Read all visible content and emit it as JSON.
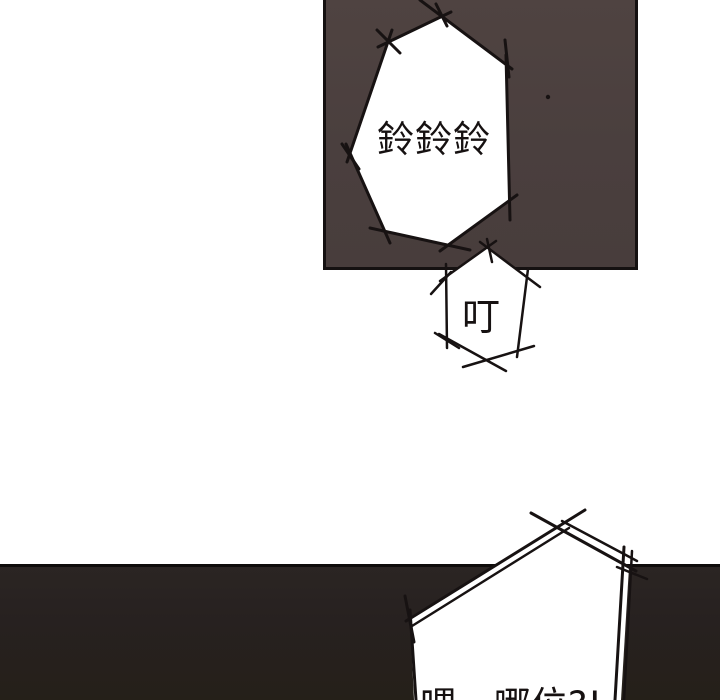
{
  "page": {
    "background_color": "#ffffff",
    "ink_color": "#171212"
  },
  "panels": {
    "top": {
      "fill_color": "#4a3f3e",
      "border_color": "#151111"
    },
    "bottom": {
      "fill_color": "#272120",
      "border_color": "#0f0c0b"
    }
  },
  "bubbles": {
    "ring_sfx": {
      "text": "鈴鈴鈴"
    },
    "ding_sfx": {
      "text": "叮"
    },
    "phone_speech": {
      "text": "喂，哪位?!"
    }
  }
}
